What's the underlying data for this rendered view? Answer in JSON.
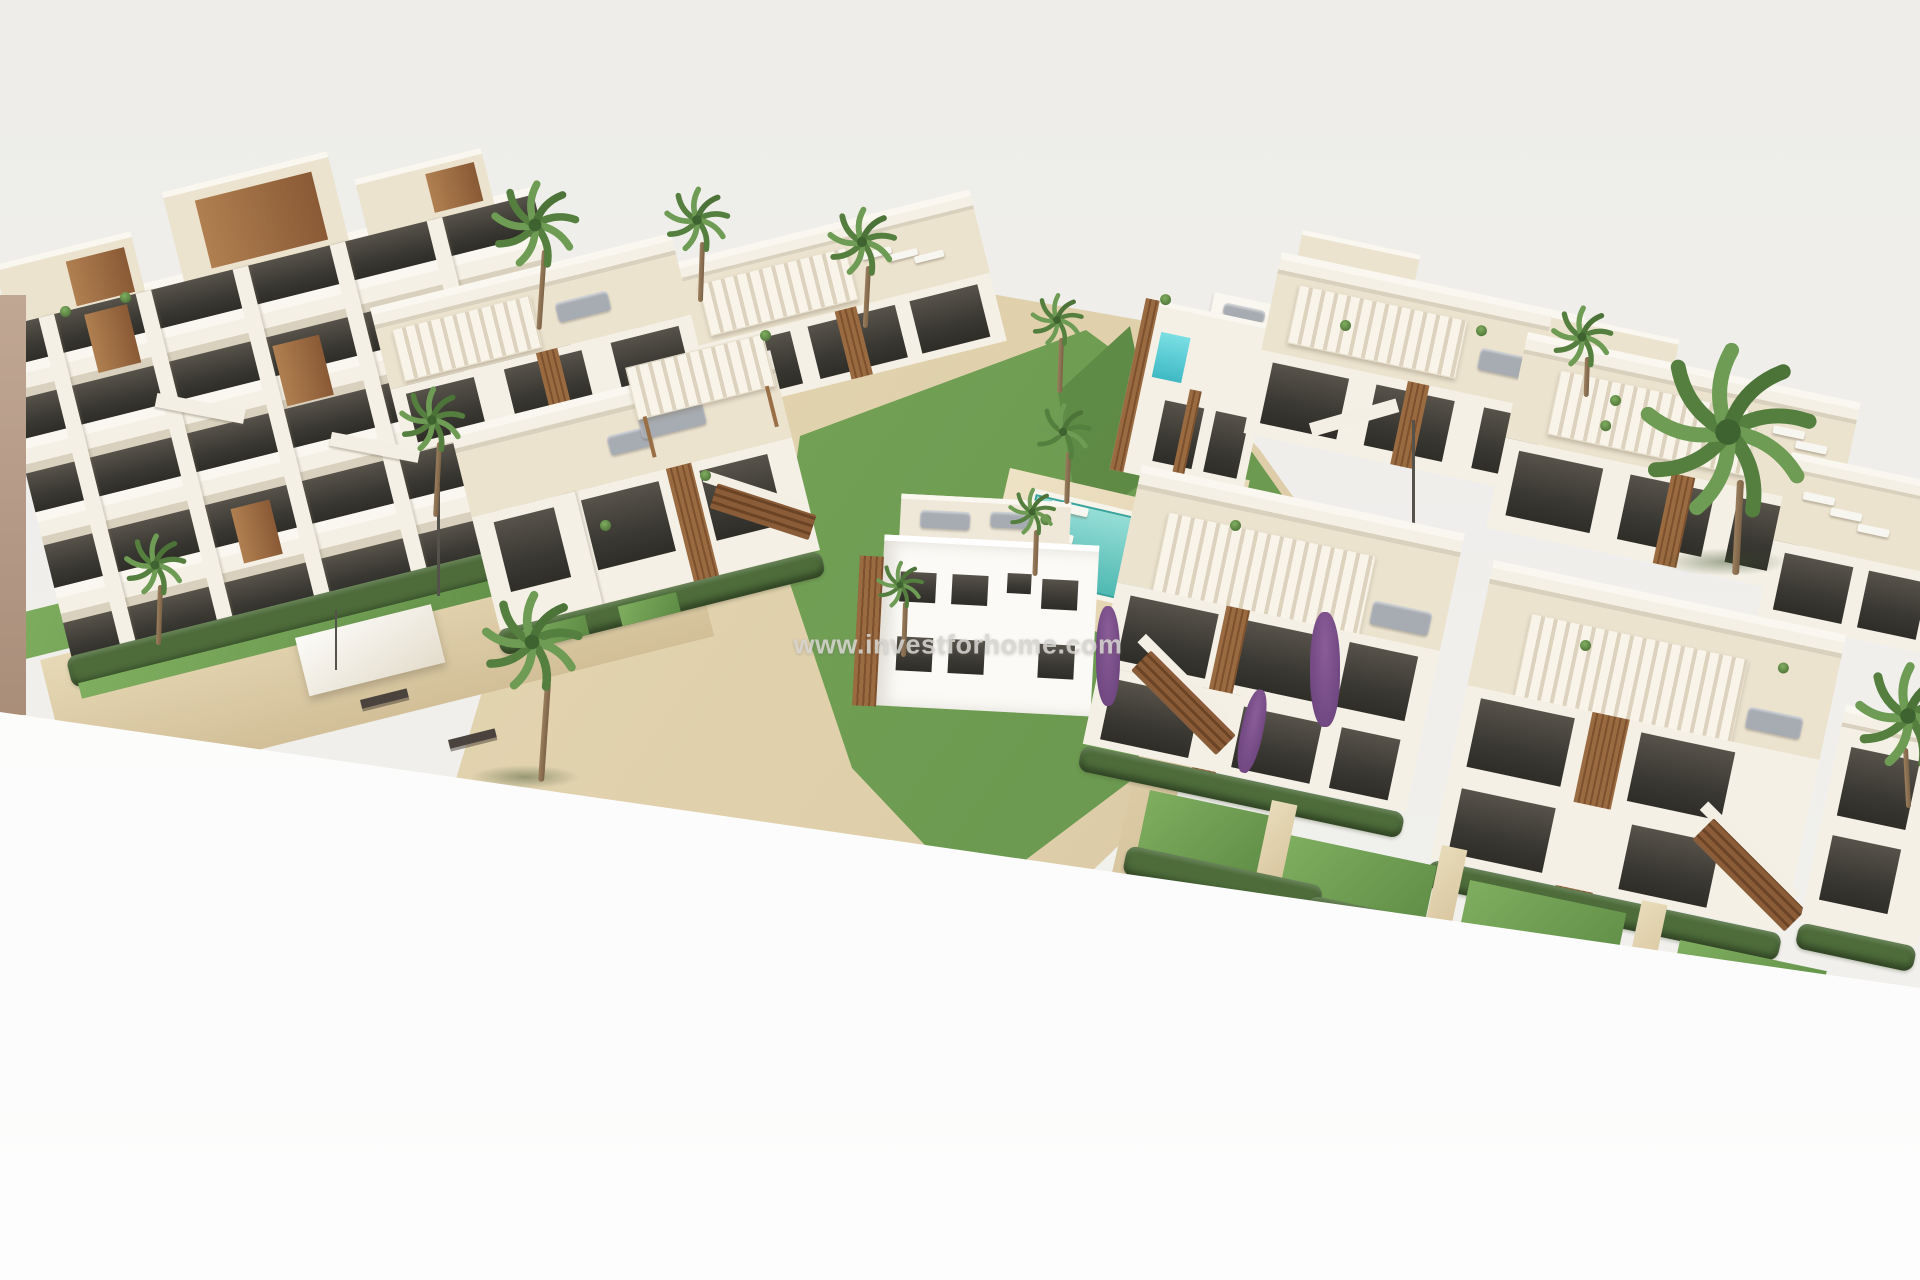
{
  "meta": {
    "type": "architectural-3d-render",
    "subject": "Aerial 3D render of a modern new-build residential complex: white apartment block with stepped balconies, two-storey townhouses with rooftop solariums and pergolas, gardens, palm trees and a communal turquoise pool, on a plain light-grey background"
  },
  "watermark": {
    "text": "www.investforhome.com"
  },
  "palette": {
    "bg_top": "#eeedea",
    "bg_bottom": "#fdfdfd",
    "wall_cap": "#faf7f0",
    "wall_light": "#f4f0e5",
    "wall_cream": "#ece3cf",
    "wall_shadow": "#d9d1bd",
    "glass_dark": "#3b3933",
    "wood": "#a0714a",
    "wood_dark": "#85583a",
    "grass": "#71a055",
    "grass_dark": "#55803e",
    "hedge": "#4d6c3a",
    "pool": "#5fc6bf",
    "sand": "#decfab",
    "sofa": "#a7acb2",
    "palm": "#5d8a46",
    "trunk": "#8d7156",
    "purple": "#7b4f88",
    "watermark": "#d6d4d0"
  },
  "regions": {
    "left_block": "multi-storey apartment building with stepped white balconies and wood accents",
    "center_townhouses": "two-storey townhouses with rooftop terraces and pergolas",
    "courtyard": "communal garden with lawn, sun loungers and swimming pool",
    "villa": "small white villa with teal glass balcony",
    "right_cluster": "rows of townhouses with striped pergola canopies and wooden stairs"
  }
}
